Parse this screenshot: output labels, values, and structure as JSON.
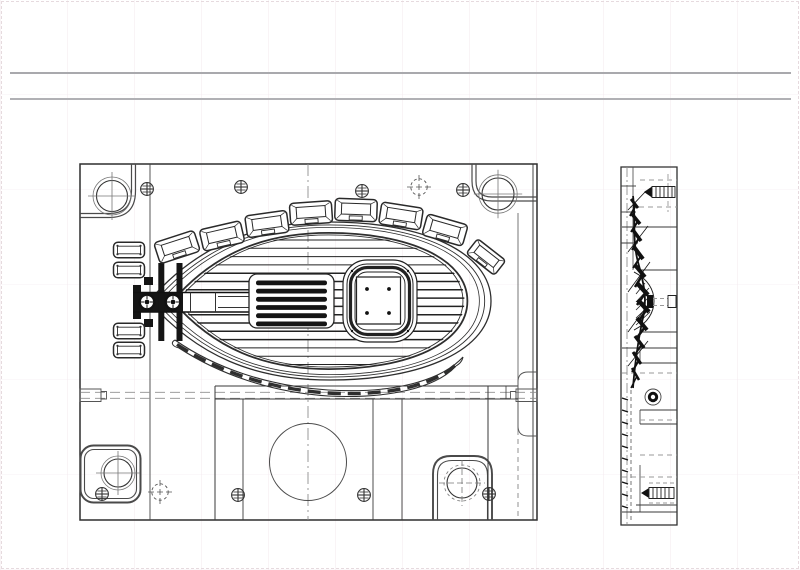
{
  "page": {
    "background": "#ffffff",
    "border_color": "#e6dade",
    "rule_color": "#a9a9ad",
    "title": "",
    "visible_text": []
  },
  "drawing": {
    "ink": "#2e2e2e",
    "thin": "#555555",
    "gray": "#8a8a8a",
    "centerline": "#979797",
    "plan_view": {
      "x": 80,
      "y": 164,
      "w": 457,
      "h": 356
    },
    "side_view": {
      "x": 621,
      "y": 167,
      "w": 56,
      "h": 358
    },
    "egg": {
      "cx": 320,
      "cy": 301,
      "rx": 171,
      "ry": 79,
      "ring_scales": [
        1,
        0.963,
        0.932,
        0.862,
        0.836
      ],
      "ring_strokes": [
        1.3,
        0.9,
        0.8,
        1.8,
        0.9
      ],
      "clip_scale": 0.845
    },
    "ribs": {
      "x1": 160,
      "x2": 482,
      "y0": 240,
      "step": 8.3,
      "count": 16
    },
    "rib_block": {
      "x": 249,
      "y": 274,
      "w": 85,
      "h": 54,
      "bar_h": 4.8,
      "bars": 6
    },
    "bosses": {
      "size": {
        "w": 42,
        "h": 22,
        "iw": 29,
        "ih": 11
      },
      "items": [
        {
          "x": 177,
          "y": 247,
          "a": -18,
          "s": 1
        },
        {
          "x": 222,
          "y": 236,
          "a": -13,
          "s": 1
        },
        {
          "x": 267,
          "y": 224,
          "a": -8,
          "s": 1
        },
        {
          "x": 311,
          "y": 213,
          "a": -4,
          "s": 1
        },
        {
          "x": 356,
          "y": 210,
          "a": 2,
          "s": 1
        },
        {
          "x": 401,
          "y": 216,
          "a": 9,
          "s": 1
        },
        {
          "x": 445,
          "y": 230,
          "a": 16,
          "s": 1
        },
        {
          "x": 486,
          "y": 257,
          "a": 38,
          "s": 0.85
        }
      ]
    },
    "left_stack": [
      {
        "x": 129,
        "y": 250
      },
      {
        "x": 129,
        "y": 270
      },
      {
        "x": 129,
        "y": 331
      },
      {
        "x": 129,
        "y": 350
      }
    ],
    "screw_marks": [
      {
        "x": 147,
        "y": 189
      },
      {
        "x": 241,
        "y": 187
      },
      {
        "x": 362,
        "y": 191
      },
      {
        "x": 463,
        "y": 190
      },
      {
        "x": 102,
        "y": 494
      },
      {
        "x": 238,
        "y": 495
      },
      {
        "x": 364,
        "y": 495
      },
      {
        "x": 489,
        "y": 494
      }
    ],
    "crosshair_marks": [
      {
        "x": 419,
        "y": 187
      },
      {
        "x": 160,
        "y": 492
      }
    ],
    "runner_screws": [
      {
        "x": 147,
        "y": 302
      },
      {
        "x": 173,
        "y": 302
      }
    ],
    "guide_circles": [
      {
        "x": 112,
        "y": 196,
        "r": 15.5,
        "r2": 19,
        "dashed": false
      },
      {
        "x": 498,
        "y": 194,
        "r": 16,
        "r2": 19.2,
        "dashed": false
      },
      {
        "x": 118,
        "y": 473,
        "r": 14,
        "r2": 17,
        "dashed": false
      },
      {
        "x": 462,
        "y": 483,
        "r": 15,
        "r2": 18,
        "dashed": true
      }
    ],
    "big_circle": {
      "x": 308,
      "y": 462,
      "r": 38.5
    },
    "profile_strokes": [
      [
        631,
        199,
        638,
        208,
        3
      ],
      [
        636,
        205,
        630,
        216,
        2
      ],
      [
        632,
        214,
        640,
        224,
        3.5
      ],
      [
        638,
        221,
        631,
        232,
        2
      ],
      [
        633,
        230,
        641,
        241,
        3.5
      ],
      [
        639,
        238,
        632,
        250,
        2
      ],
      [
        634,
        247,
        643,
        259,
        4
      ],
      [
        641,
        256,
        633,
        268,
        2
      ],
      [
        635,
        265,
        645,
        277,
        4
      ],
      [
        643,
        274,
        635,
        287,
        2.5
      ],
      [
        637,
        283,
        648,
        295,
        4.5
      ],
      [
        646,
        292,
        637,
        305,
        2.5
      ],
      [
        638,
        300,
        649,
        312,
        4.5
      ],
      [
        647,
        309,
        638,
        322,
        2.5
      ],
      [
        637,
        318,
        647,
        330,
        4
      ],
      [
        645,
        327,
        636,
        339,
        2.5
      ],
      [
        635,
        336,
        644,
        348,
        3.5
      ],
      [
        642,
        344,
        634,
        356,
        2
      ],
      [
        633,
        352,
        641,
        364,
        3
      ],
      [
        639,
        360,
        632,
        372,
        2
      ],
      [
        632,
        368,
        639,
        380,
        2.5
      ],
      [
        637,
        376,
        631,
        388,
        1.5
      ],
      [
        628,
        210,
        646,
        191,
        0.8
      ],
      [
        628,
        252,
        648,
        226,
        0.8
      ],
      [
        628,
        292,
        650,
        262,
        0.8
      ],
      [
        628,
        332,
        650,
        302,
        0.8
      ],
      [
        628,
        366,
        648,
        341,
        0.8
      ],
      [
        622,
        398,
        628,
        400,
        1.4
      ],
      [
        622,
        410,
        628,
        412,
        1.4
      ],
      [
        622,
        422,
        628,
        424,
        1.4
      ],
      [
        622,
        434,
        628,
        436,
        1.4
      ],
      [
        622,
        446,
        628,
        448,
        1.4
      ],
      [
        622,
        458,
        628,
        460,
        1.4
      ],
      [
        622,
        470,
        628,
        472,
        1.4
      ],
      [
        622,
        482,
        628,
        484,
        1.4
      ],
      [
        622,
        494,
        628,
        496,
        1.4
      ],
      [
        622,
        506,
        628,
        508,
        1.4
      ]
    ]
  }
}
